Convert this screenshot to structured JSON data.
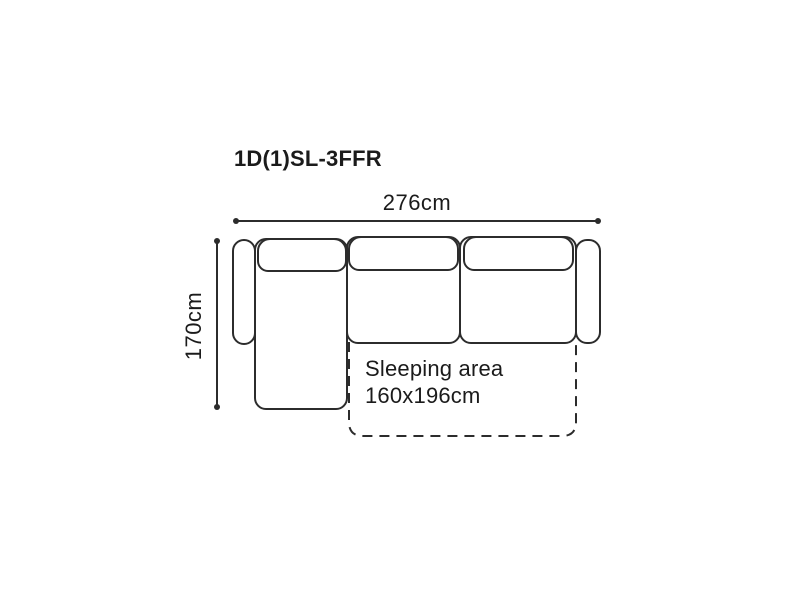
{
  "diagram": {
    "title": "1D(1)SL-3FFR",
    "dimensions": {
      "width_label": "276cm",
      "depth_label": "170cm"
    },
    "sleeping_area": {
      "label": "Sleeping area",
      "size": "160x196cm"
    },
    "colors": {
      "outline": "#2c2c2c",
      "text": "#1b1b1b",
      "background": "#ffffff"
    }
  }
}
